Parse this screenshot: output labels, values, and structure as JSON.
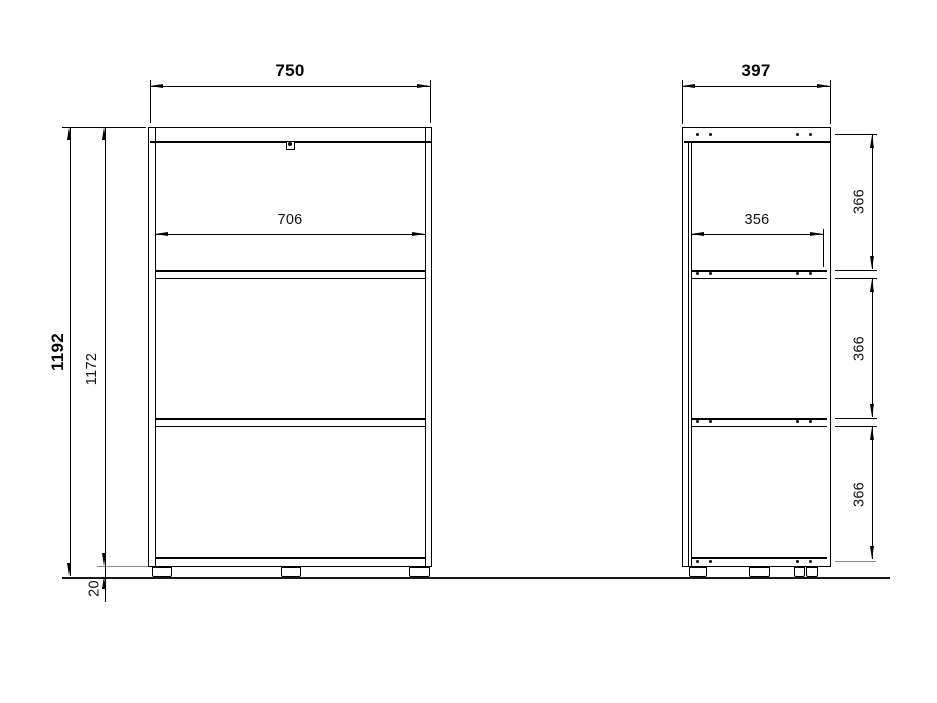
{
  "drawing": {
    "front_view": {
      "overall_width": "750",
      "inner_width": "706",
      "overall_height": "1192",
      "carcass_height": "1172",
      "plinth_height": "20"
    },
    "side_view": {
      "overall_depth": "397",
      "inner_depth": "356",
      "compartment_heights": [
        "366",
        "366",
        "366"
      ]
    }
  }
}
